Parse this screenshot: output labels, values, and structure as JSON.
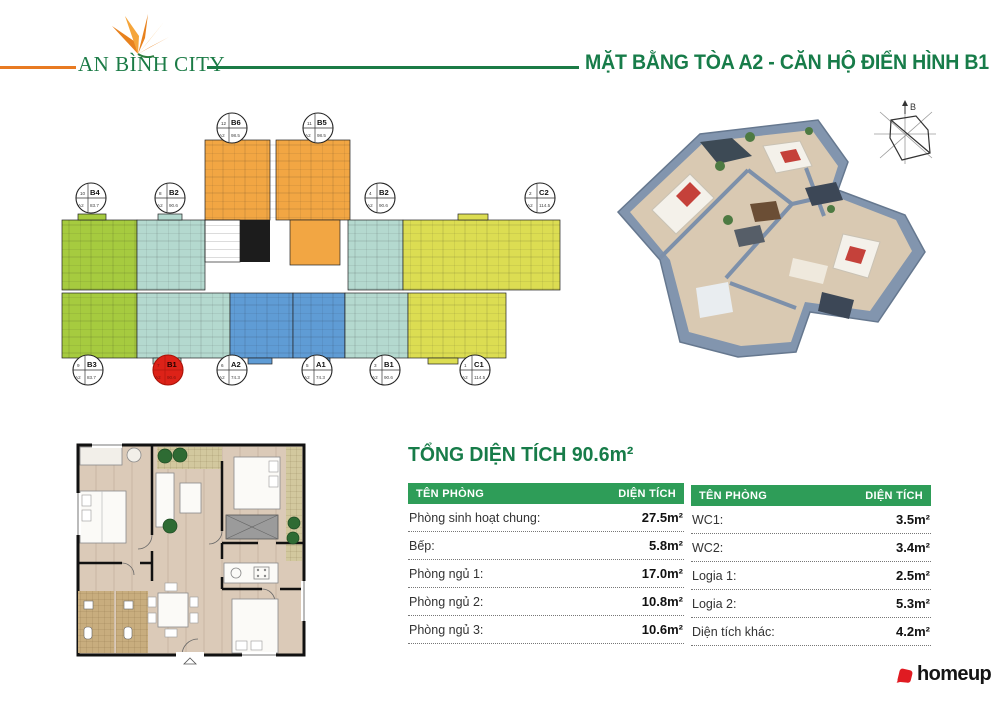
{
  "header": {
    "brand": "AN BÌNH CITY",
    "title": "MẶT BẰNG TÒA A2 - CĂN HỘ ĐIỂN HÌNH B1"
  },
  "colors": {
    "brand_orange": "#e87a22",
    "brand_green": "#1b7b46",
    "title_green": "#177c49",
    "table_header": "#2e9d58",
    "unit_green": "#a6cb3f",
    "unit_teal": "#b4d9cf",
    "unit_blue": "#5f9cd5",
    "unit_yellow": "#dcdd52",
    "unit_orange": "#f2a643",
    "highlight_red": "#dd2218",
    "homeup_red": "#e01b22"
  },
  "floor_schematic": {
    "compass_label": "B",
    "units": [
      {
        "no": "12",
        "code": "B6",
        "area": "A2 98.5",
        "x": 174,
        "y": 23,
        "highlight": false
      },
      {
        "no": "11",
        "code": "B5",
        "area": "A2 98.5",
        "x": 260,
        "y": 23,
        "highlight": false
      },
      {
        "no": "10",
        "code": "B4",
        "area": "A2 83.7",
        "x": 33,
        "y": 93,
        "highlight": false
      },
      {
        "no": "8",
        "code": "B2",
        "area": "A2 90.6",
        "x": 112,
        "y": 93,
        "highlight": false
      },
      {
        "no": "4",
        "code": "B2",
        "area": "A2 90.6",
        "x": 322,
        "y": 93,
        "highlight": false
      },
      {
        "no": "2",
        "code": "C2",
        "area": "A2 114.5",
        "x": 482,
        "y": 93,
        "highlight": false
      },
      {
        "no": "9",
        "code": "B3",
        "area": "A2 83.7",
        "x": 30,
        "y": 265,
        "highlight": false
      },
      {
        "no": "7",
        "code": "B1",
        "area": "A2 90.6",
        "x": 110,
        "y": 265,
        "highlight": true
      },
      {
        "no": "6",
        "code": "A2",
        "area": "A2 74.3",
        "x": 174,
        "y": 265,
        "highlight": false
      },
      {
        "no": "5",
        "code": "A1",
        "area": "A2 74.3",
        "x": 259,
        "y": 265,
        "highlight": false
      },
      {
        "no": "3",
        "code": "B1",
        "area": "A2 90.6",
        "x": 327,
        "y": 265,
        "highlight": false
      },
      {
        "no": "1",
        "code": "C1",
        "area": "A2 114.5",
        "x": 417,
        "y": 265,
        "highlight": false
      }
    ]
  },
  "summary": {
    "title": "TỔNG DIỆN TÍCH 90.6m²",
    "col_room": "TÊN PHÒNG",
    "col_area": "DIỆN TÍCH",
    "table_left": [
      {
        "room": "Phòng sinh hoạt chung:",
        "area": "27.5m²"
      },
      {
        "room": "Bếp:",
        "area": "5.8m²"
      },
      {
        "room": "Phòng ngủ 1:",
        "area": "17.0m²"
      },
      {
        "room": "Phòng ngủ 2:",
        "area": "10.8m²"
      },
      {
        "room": "Phòng ngủ 3:",
        "area": "10.6m²"
      }
    ],
    "table_right": [
      {
        "room": "WC1:",
        "area": "3.5m²"
      },
      {
        "room": "WC2:",
        "area": "3.4m²"
      },
      {
        "room": "Logia 1:",
        "area": "2.5m²"
      },
      {
        "room": "Logia 2:",
        "area": "5.3m²"
      },
      {
        "room": "Diện tích khác:",
        "area": "4.2m²"
      }
    ]
  },
  "footer": {
    "logo_text": "homeup"
  }
}
